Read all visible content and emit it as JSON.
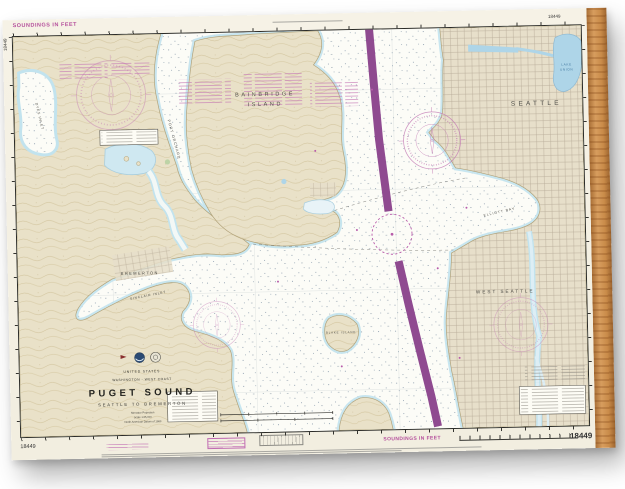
{
  "product": {
    "type": "nautical chart wood print",
    "background_color": "#ffffff",
    "wood_edge_color": "#c98b49"
  },
  "margins": {
    "soundings_note": "SOUNDINGS IN FEET",
    "chart_number": "18449"
  },
  "title_block": {
    "country": "UNITED STATES",
    "region": "WASHINGTON - WEST COAST",
    "title": "PUGET SOUND",
    "subtitle": "SEATTLE TO BREMERTON",
    "projection": "Mercator Projection",
    "scale": "Scale 1:25,000",
    "datum": "North American Datum of 1983"
  },
  "map_labels": {
    "bainbridge_1": "BAINBRIDGE",
    "bainbridge_2": "ISLAND",
    "seattle": "SEATTLE",
    "west_seattle": "WEST  SEATTLE",
    "bremerton": "BREMERTON",
    "lake_union_1": "LAKE",
    "lake_union_2": "UNION",
    "port_orchard": "PORT ORCHARD",
    "dyes_inlet": "DYES INLET",
    "sinclair_inlet": "SINCLAIR INLET",
    "elliott_bay": "ELLIOTT BAY",
    "blake_island": "BLAKE ISLAND"
  },
  "colors": {
    "land": "#e9e1c8",
    "water": "#fbfbf5",
    "shallow_fringe": "#c2e3ee",
    "lake": "#aed5e8",
    "magenta": "#b85caa",
    "traffic_lane": "#8f4a90",
    "neatline": "#2a2a26"
  }
}
